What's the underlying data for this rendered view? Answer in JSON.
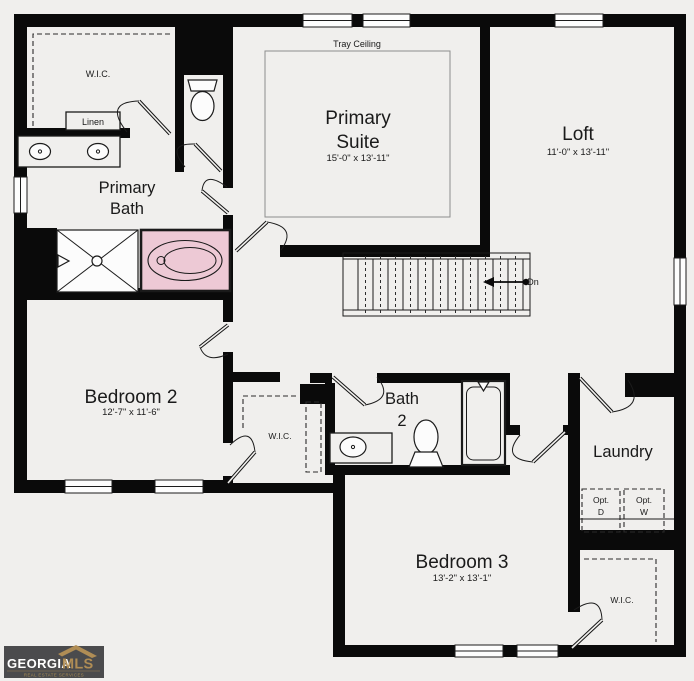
{
  "rooms": {
    "primary_wic": {
      "label": "W.I.C."
    },
    "linen": {
      "label": "Linen"
    },
    "primary_bath": {
      "line1": "Primary",
      "line2": "Bath"
    },
    "primary_suite": {
      "note": "Tray Ceiling",
      "line1": "Primary",
      "line2": "Suite",
      "dims": "15'-0\" x 13'-11\""
    },
    "loft": {
      "label": "Loft",
      "dims": "11'-0\" x 13'-11\""
    },
    "bedroom2": {
      "label": "Bedroom 2",
      "dims": "12'-7\" x 11'-6\""
    },
    "bedroom2_wic": {
      "label": "W.I.C."
    },
    "bath2": {
      "line1": "Bath",
      "line2": "2"
    },
    "laundry": {
      "label": "Laundry",
      "opt_d_line1": "Opt.",
      "opt_d_line2": "D",
      "opt_w_line1": "Opt.",
      "opt_w_line2": "W"
    },
    "bedroom3": {
      "label": "Bedroom 3",
      "dims": "13'-2\" x 13'-1\""
    },
    "bedroom3_wic": {
      "label": "W.I.C."
    }
  },
  "stairs": {
    "down_label": "Dn"
  },
  "logo": {
    "brand": "GEORGIA",
    "brand2": "MLS",
    "tagline": "REAL ESTATE SERVICES"
  },
  "colors": {
    "wall": "#0a0a0a",
    "canvas": "#f0efed",
    "tub_highlight": "#edc9d5",
    "logo_bg": "#4b4b4d",
    "logo_gold": "#b08d55"
  }
}
